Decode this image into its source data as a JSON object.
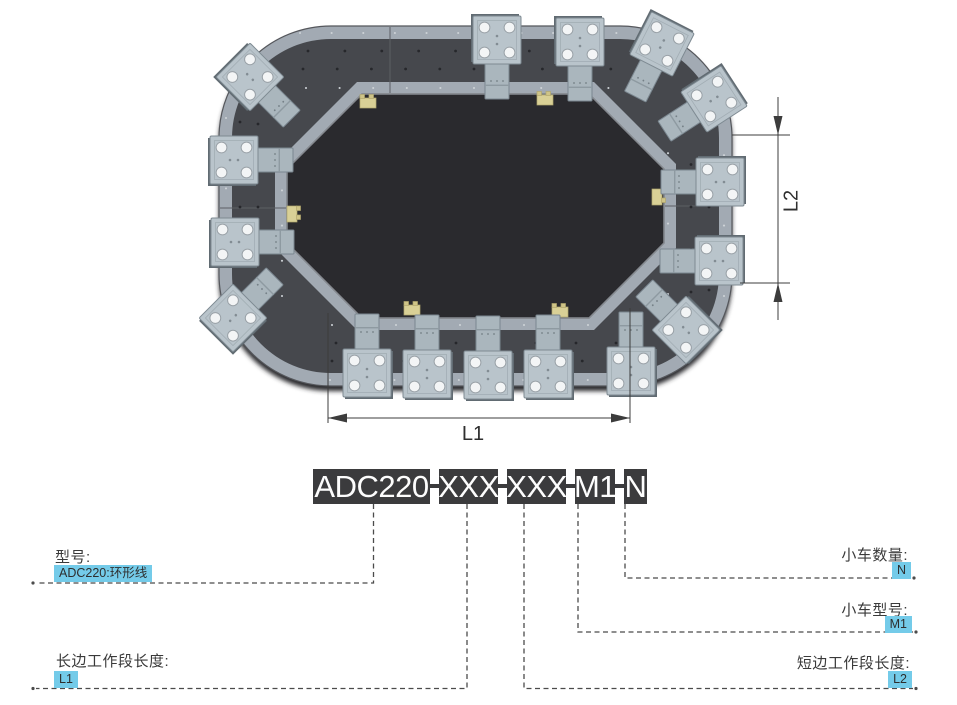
{
  "colors": {
    "highlight_bg": "#74cbe9",
    "code_block_bg": "#3b3b3d",
    "track_dark": "#46484d",
    "track_rail": "#a2aab3",
    "carriage_plate": "#b9c4cb",
    "line": "#4b4b4b"
  },
  "illustration": {
    "description": "ring-conveyor-top-view",
    "dim_l1": "L1",
    "dim_l2": "L2"
  },
  "model_code": {
    "segments": [
      "ADC220",
      "XXX",
      "XXX",
      "M1",
      "N"
    ],
    "separator": "-"
  },
  "callouts": {
    "model": {
      "label": "型号:",
      "value": "ADC220:环形线"
    },
    "long_side": {
      "label": "长边工作段长度:",
      "value": "L1"
    },
    "cart_count": {
      "label": "小车数量:",
      "value": "N"
    },
    "cart_model": {
      "label": "小车型号:",
      "value": "M1"
    },
    "short_side": {
      "label": "短边工作段长度:",
      "value": "L2"
    }
  }
}
